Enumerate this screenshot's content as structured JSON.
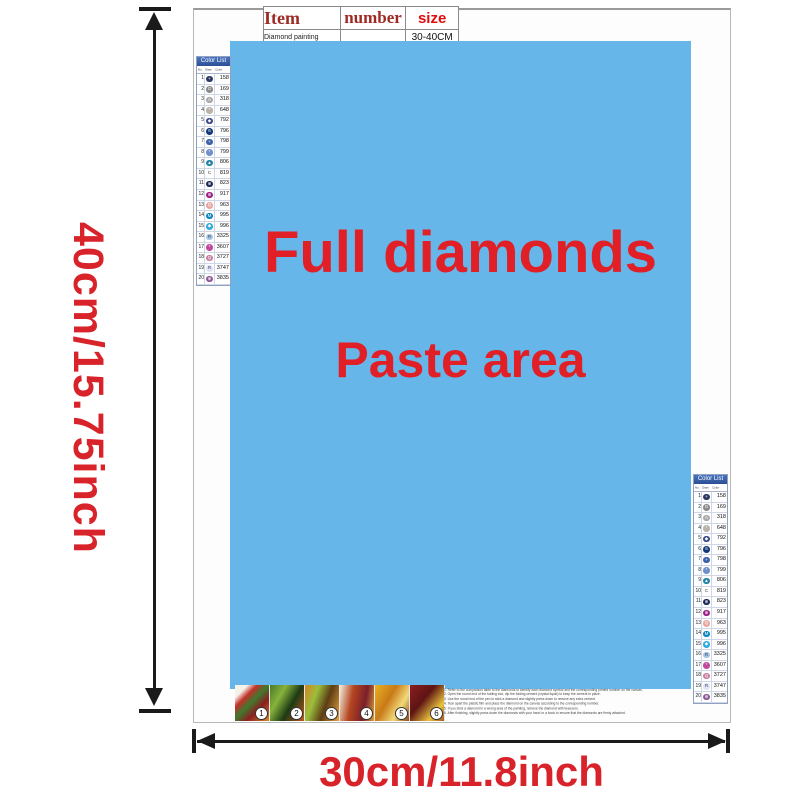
{
  "colors": {
    "paste_bg": "#67b6e9",
    "accent_red": "#e01f26",
    "dim_red": "#d8232a",
    "table_header_red": "#9d2b24",
    "size_red": "#e10c0c",
    "list_header_bg": "#4a74c0",
    "arrow_black": "#1a1a1a"
  },
  "dimensions": {
    "height_label": "40cm/15.75inch",
    "width_label": "30cm/11.8inch"
  },
  "spec_table": {
    "headers": [
      "Item",
      "number",
      "size"
    ],
    "row": [
      "Diamond painting",
      "",
      "30-40CM"
    ]
  },
  "paste_area": {
    "line1": "Full diamonds",
    "line2": "Paste area"
  },
  "color_list": {
    "title": "Color List",
    "columns": [
      "No.",
      "Diamond",
      "Color"
    ],
    "rows": [
      {
        "no": "1",
        "symbol": "+",
        "code": "158",
        "fill": "#2e3963",
        "sym_color": "#ffffff"
      },
      {
        "no": "2",
        "symbol": "G",
        "code": "169",
        "fill": "#8a8a8a",
        "sym_color": "#ffffff"
      },
      {
        "no": "3",
        "symbol": "A",
        "code": "318",
        "fill": "#a8a8a8",
        "sym_color": "#ffffff"
      },
      {
        "no": "4",
        "symbol": "*",
        "code": "648",
        "fill": "#b8b2a7",
        "sym_color": "#ffffff"
      },
      {
        "no": "5",
        "symbol": "◆",
        "code": "792",
        "fill": "#3b4a86",
        "sym_color": "#ffffff"
      },
      {
        "no": "6",
        "symbol": "6",
        "code": "796",
        "fill": "#123a78",
        "sym_color": "#ffffff"
      },
      {
        "no": "7",
        "symbol": "+",
        "code": "798",
        "fill": "#3a62a8",
        "sym_color": "#ffffff"
      },
      {
        "no": "8",
        "symbol": "*",
        "code": "799",
        "fill": "#6e8fc9",
        "sym_color": "#ffffff"
      },
      {
        "no": "9",
        "symbol": "▲",
        "code": "806",
        "fill": "#2584a8",
        "sym_color": "#ffffff"
      },
      {
        "no": "10",
        "symbol": "C",
        "code": "819",
        "fill": "none",
        "sym_color": "#333333"
      },
      {
        "no": "11",
        "symbol": "⊕",
        "code": "823",
        "fill": "#1b2a55",
        "sym_color": "#ffffff"
      },
      {
        "no": "12",
        "symbol": "⊕",
        "code": "917",
        "fill": "#9c1f86",
        "sym_color": "#ffffff"
      },
      {
        "no": "13",
        "symbol": "Q",
        "code": "963",
        "fill": "#e9a5a0",
        "sym_color": "#ffffff"
      },
      {
        "no": "14",
        "symbol": "M",
        "code": "995",
        "fill": "#0d86c2",
        "sym_color": "#ffffff"
      },
      {
        "no": "15",
        "symbol": "◆",
        "code": "996",
        "fill": "#33aadd",
        "sym_color": "#ffffff"
      },
      {
        "no": "16",
        "symbol": "R",
        "code": "3325",
        "fill": "#a8c6e4",
        "sym_color": "#334466"
      },
      {
        "no": "17",
        "symbol": "*",
        "code": "3607",
        "fill": "#c04a9e",
        "sym_color": "#ffffff"
      },
      {
        "no": "18",
        "symbol": "Q",
        "code": "3727",
        "fill": "#c77f9f",
        "sym_color": "#ffffff"
      },
      {
        "no": "19",
        "symbol": "R",
        "code": "3747",
        "fill": "#dfe3f5",
        "sym_color": "#444466"
      },
      {
        "no": "20",
        "symbol": "⊕",
        "code": "3835",
        "fill": "#8f5a93",
        "sym_color": "#ffffff"
      }
    ]
  },
  "steps": {
    "tiles": [
      {
        "label": "1",
        "gradient": "linear-gradient(135deg,#f5f2ea 0%,#f5f2ea 18%,#c23028 32%,#3f7a2e 48%,#8c1f1f 68%,#d9892a 100%)"
      },
      {
        "label": "2",
        "gradient": "linear-gradient(120deg,#4a7a28 0%,#86b23c 30%,#1d3a14 60%,#c2581e 100%)"
      },
      {
        "label": "3",
        "gradient": "linear-gradient(110deg,#d9821e 0%,#9abf3c 30%,#5d3c14 60%,#e8a33c 100%)"
      },
      {
        "label": "4",
        "gradient": "linear-gradient(100deg,#f2ecdc 0%,#b5451f 35%,#7a1f2a 70%,#d9a03c 100%)"
      },
      {
        "label": "5",
        "gradient": "linear-gradient(120deg,#e8b020 0%,#c97a18 40%,#f2d97a 70%,#8c4a12 100%)"
      },
      {
        "label": "6",
        "gradient": "linear-gradient(130deg,#8c1f1f 0%,#5e1414 40%,#e8c23c 75%,#a85a1e 100%)"
      }
    ],
    "instructions": [
      "1. Refer to the comparison table to the diamonds to identify each diamond symbol and the corresponding printed number on the canvas.",
      "2. Open the round end of the folding tool, dip the folding cement (crystal liquid) to keep the cement in place.",
      "3. Use the round end of the pen to stick a diamond and slightly press down to remove any extra cement.",
      "4. Tear apart the plastic film and place the diamond on the canvas according to the corresponding number.",
      "5. If you stick a diamond in a wrong area of the painting, remove the diamond with tweezers.",
      "6. After finishing, slightly press down the diamonds with your hand or a book to ensure that the diamonds are firmly attached."
    ]
  }
}
